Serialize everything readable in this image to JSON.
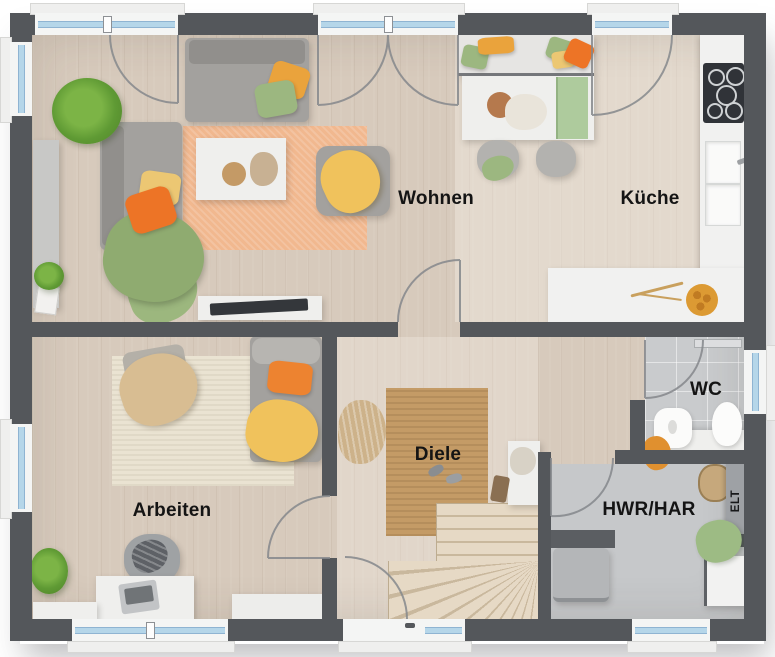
{
  "rooms": {
    "living": "Wohnen",
    "kitchen": "Küche",
    "office": "Arbeiten",
    "hallway": "Diele",
    "wc": "WC",
    "utility": "HWR/HAR",
    "electrical": "ELT"
  },
  "colors": {
    "wall": "#54575b",
    "wood_floor": "#d7cabc",
    "tile_floor": "#c9cbcd",
    "window_glass": "#b5d6e9",
    "rug_living": "#f1b88f",
    "rug_office": "#eae3d2",
    "rug_hallway": "#c49b66",
    "stairs_wood": "#e6d9c5",
    "accent_orange": "#ed8330",
    "accent_amber": "#eaa33c",
    "accent_yellow": "#f0c25c",
    "accent_green": "#9cb780",
    "label_text": "#141414"
  }
}
